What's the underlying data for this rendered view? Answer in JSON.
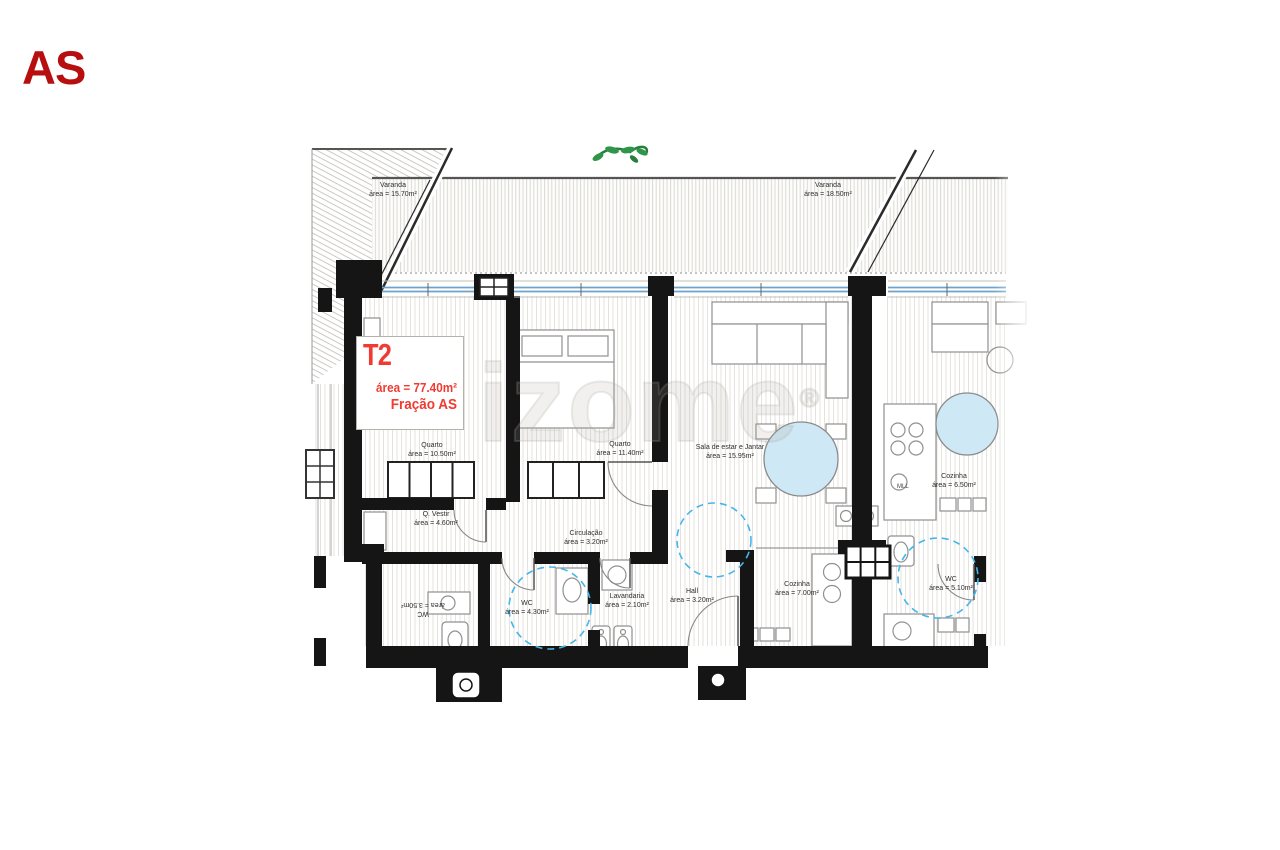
{
  "page": {
    "corner_label": "AS"
  },
  "watermark": {
    "text": "izome",
    "registered": "®"
  },
  "unit_card": {
    "code": "T2",
    "area": "área = 77.40m²",
    "fraction": "Fração AS"
  },
  "rooms": {
    "varanda_left": {
      "name": "Varanda",
      "area": "área = 15.70m²"
    },
    "varanda_right": {
      "name": "Varanda",
      "area": "área = 18.50m²"
    },
    "quarto_1": {
      "name": "Quarto",
      "area": "área = 10.50m²"
    },
    "quarto_2": {
      "name": "Quarto",
      "area": "área = 11.40m²"
    },
    "sala": {
      "name": "Sala de estar e Jantar",
      "area": "área = 15.95m²"
    },
    "q_vestir": {
      "name": "Q. Vestir",
      "area": "área = 4.60m²"
    },
    "circulacao": {
      "name": "Circulação",
      "area": "área = 3.20m²"
    },
    "wc_1": {
      "name": "WC",
      "area": "área = 4.30m²"
    },
    "lavandaria": {
      "name": "Lavandaria",
      "area": "área = 2.10m²"
    },
    "hall": {
      "name": "Hall",
      "area": "área = 3.20m²"
    },
    "cozinha": {
      "name": "Cozinha",
      "area": "área = 7.00m²"
    },
    "cozinha_vizinha": {
      "name": "Cozinha",
      "area": "área = 6.50m²"
    },
    "wc_vizinho": {
      "name": "WC",
      "area": "área = 5.10m²"
    },
    "wc_invertido": {
      "name": "WC",
      "area": "área = 3.50m²"
    }
  },
  "annotations": {
    "appliance_mll": "MLL"
  },
  "colors": {
    "wall": "#151515",
    "window_blue": "#6fa3cc",
    "dashed_blue": "#45b6e8",
    "table_fill": "#cfe8f5",
    "accent_red": "#ef3b31",
    "corner_red": "#b70f0f",
    "plant_green": "#2f9549",
    "hatch": "#e2dfda"
  }
}
